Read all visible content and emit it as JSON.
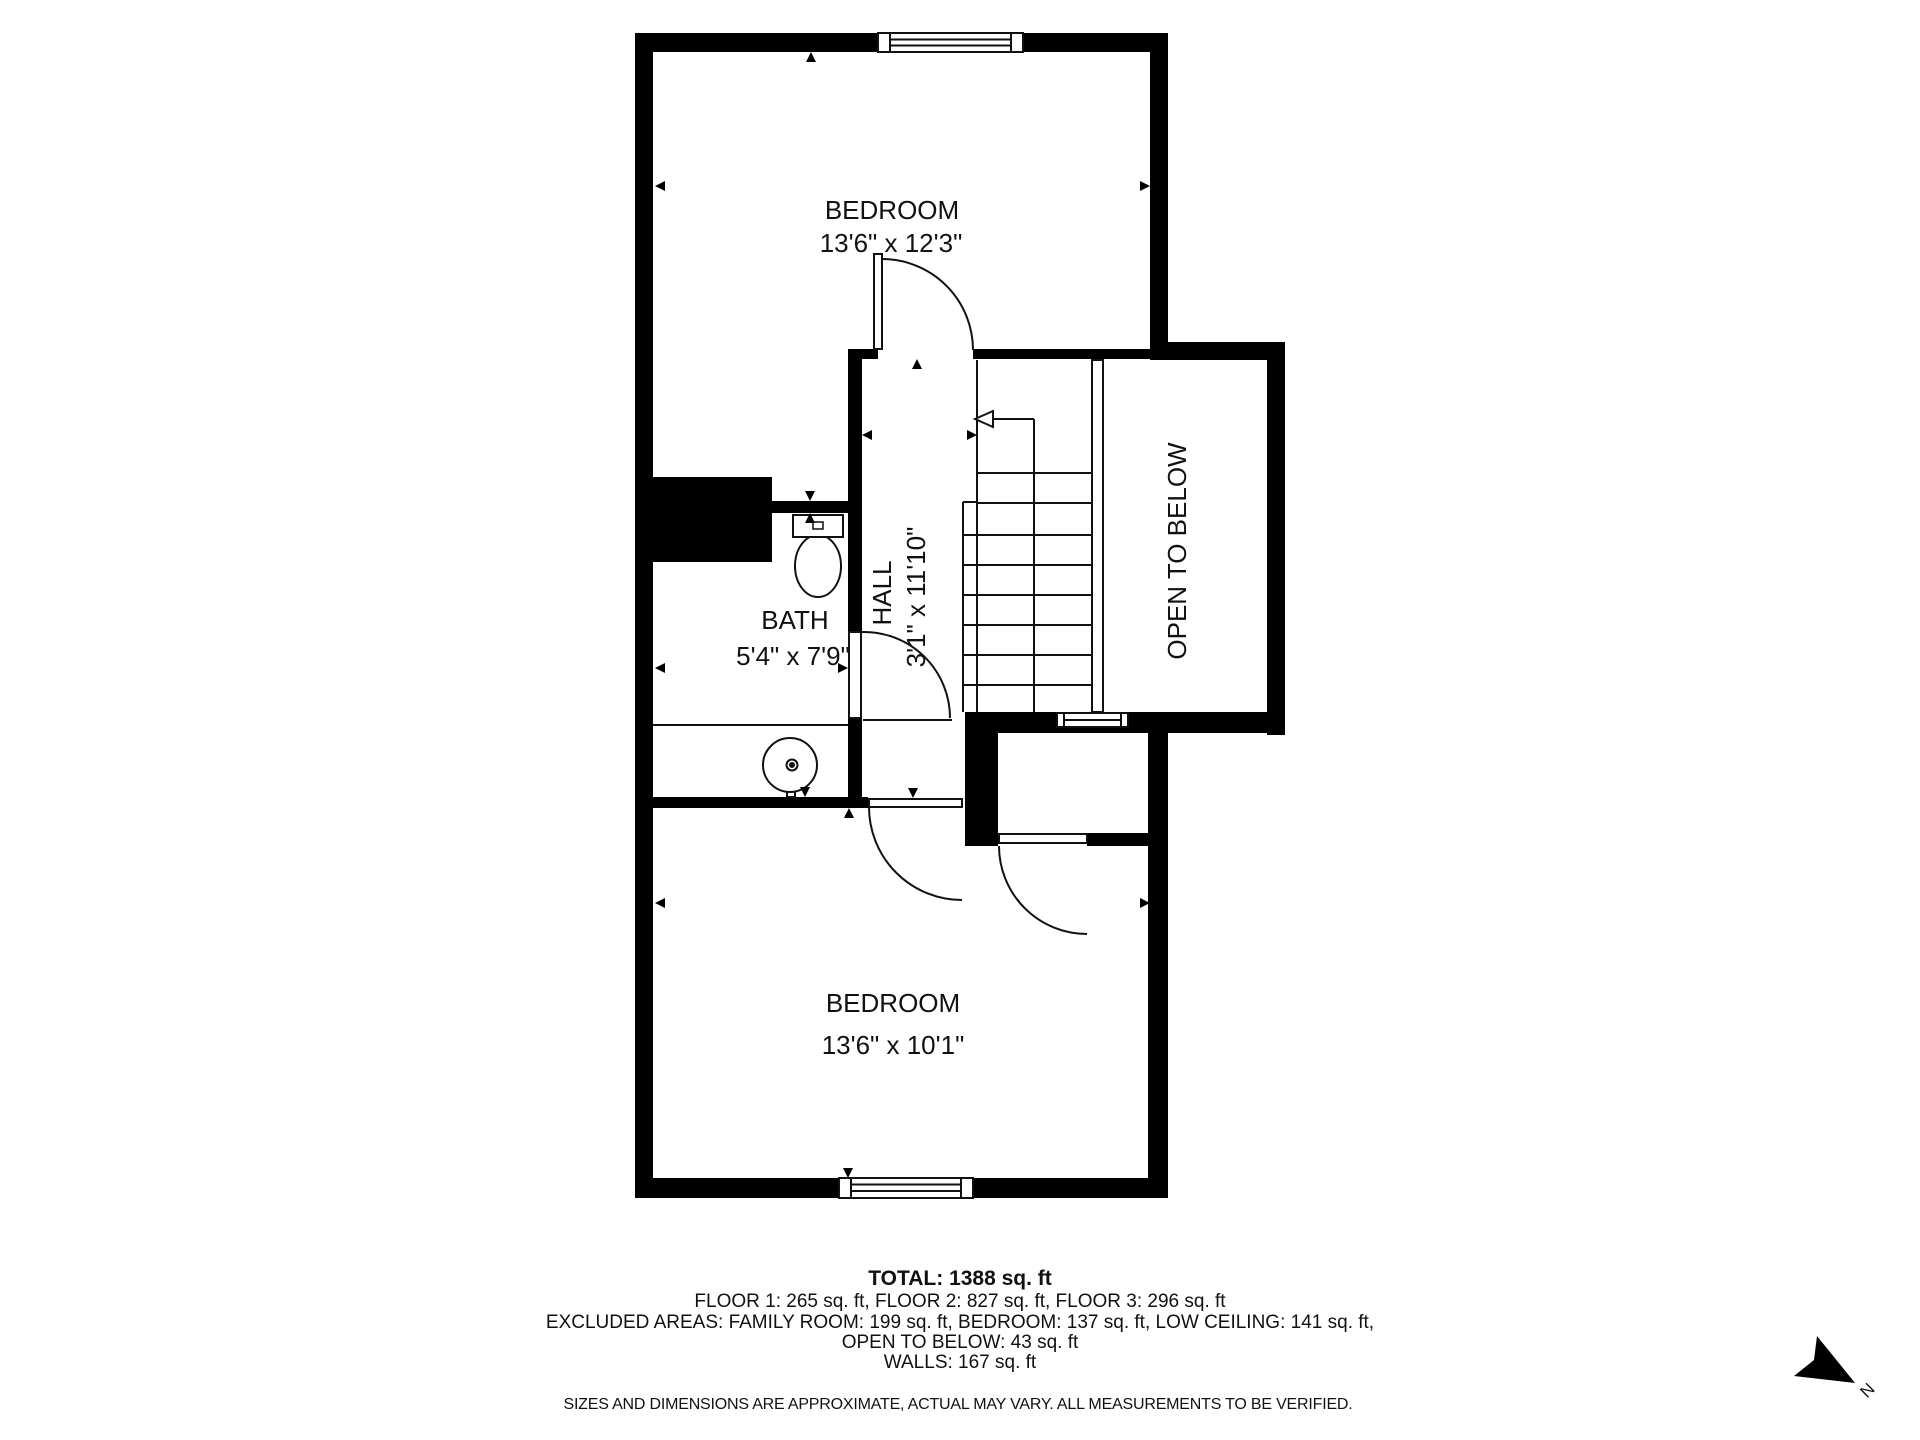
{
  "plan": {
    "rooms": [
      {
        "id": "bedroom-top",
        "label": "BEDROOM",
        "dims": "13'6\" x 12'3\""
      },
      {
        "id": "bath",
        "label": "BATH",
        "dims": "5'4\" x 7'9\""
      },
      {
        "id": "hall",
        "label": "HALL",
        "dims": "3'1\" x 11'10\""
      },
      {
        "id": "open-to-below",
        "label": "OPEN TO BELOW",
        "dims": ""
      },
      {
        "id": "bedroom-bottom",
        "label": "BEDROOM",
        "dims": "13'6\" x 10'1\""
      }
    ],
    "compass_label": "N"
  },
  "footer": {
    "total": "TOTAL: 1388 sq. ft",
    "floors": "FLOOR 1: 265 sq. ft, FLOOR 2: 827 sq. ft, FLOOR 3: 296 sq. ft",
    "excluded": "EXCLUDED AREAS: FAMILY ROOM: 199 sq. ft, BEDROOM: 137 sq. ft, LOW CEILING: 141 sq. ft,",
    "open_below": "OPEN TO BELOW: 43 sq. ft",
    "walls": "WALLS: 167 sq. ft",
    "disclaimer": "SIZES AND DIMENSIONS ARE APPROXIMATE, ACTUAL MAY VARY. ALL MEASUREMENTS TO BE VERIFIED."
  },
  "colors": {
    "wall": "#000000",
    "background": "#ffffff",
    "line": "#111111"
  }
}
